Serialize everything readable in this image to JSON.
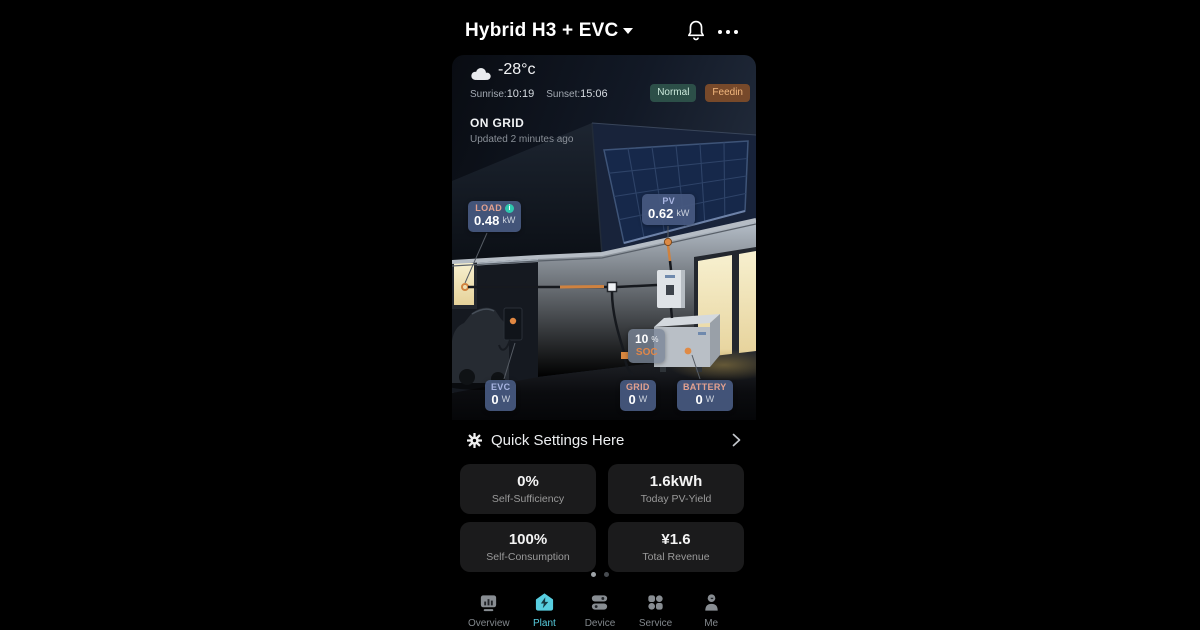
{
  "app": {
    "title": "Hybrid H3 + EVC"
  },
  "weather": {
    "temperature": "-28°c",
    "sunrise_label": "Sunrise:",
    "sunrise_time": "10:19",
    "sunset_label": "Sunset:",
    "sunset_time": "15:06"
  },
  "status_badges": {
    "normal": "Normal",
    "feedin": "Feedin"
  },
  "grid_status": {
    "mode": "ON GRID",
    "updated": "Updated 2 minutes ago"
  },
  "power": {
    "load": {
      "label": "LOAD",
      "value": "0.48",
      "unit": "kW"
    },
    "pv": {
      "label": "PV",
      "value": "0.62",
      "unit": "kW"
    },
    "evc": {
      "label": "EVC",
      "value": "0",
      "unit": "W"
    },
    "grid": {
      "label": "GRID",
      "value": "0",
      "unit": "W"
    },
    "battery": {
      "label": "BATTERY",
      "value": "0",
      "unit": "W"
    },
    "soc": {
      "value": "10",
      "percent": "%",
      "label": "SOC"
    }
  },
  "quick_settings": {
    "label": "Quick Settings Here"
  },
  "stats_cards": [
    {
      "value": "0%",
      "label": "Self-Sufficiency"
    },
    {
      "value": "1.6kWh",
      "label": "Today PV-Yield"
    },
    {
      "value": "100%",
      "label": "Self-Consumption"
    },
    {
      "value": "¥1.6",
      "label": "Total Revenue"
    }
  ],
  "pagination": {
    "dots": 2,
    "active_index": 0
  },
  "bottom_nav": [
    {
      "label": "Overview",
      "icon": "dashboard-icon",
      "active": false
    },
    {
      "label": "Plant",
      "icon": "plant-house-icon",
      "active": true
    },
    {
      "label": "Device",
      "icon": "device-stack-icon",
      "active": false
    },
    {
      "label": "Service",
      "icon": "service-grid-icon",
      "active": false
    },
    {
      "label": "Me",
      "icon": "user-icon",
      "active": false
    }
  ],
  "colors": {
    "accent_teal": "#58cee0",
    "power_badge_bg": "#47597F",
    "warm_label": "#E3A18F",
    "cool_label": "#A9B5E2",
    "soc_orange": "#E0874A",
    "normal_badge_bg": "#2C4F48",
    "normal_badge_text": "#CBE9DB",
    "feedin_badge_bg": "#77492A",
    "feedin_badge_text": "#F2B77E",
    "card_bg": "#1B1B1C"
  }
}
